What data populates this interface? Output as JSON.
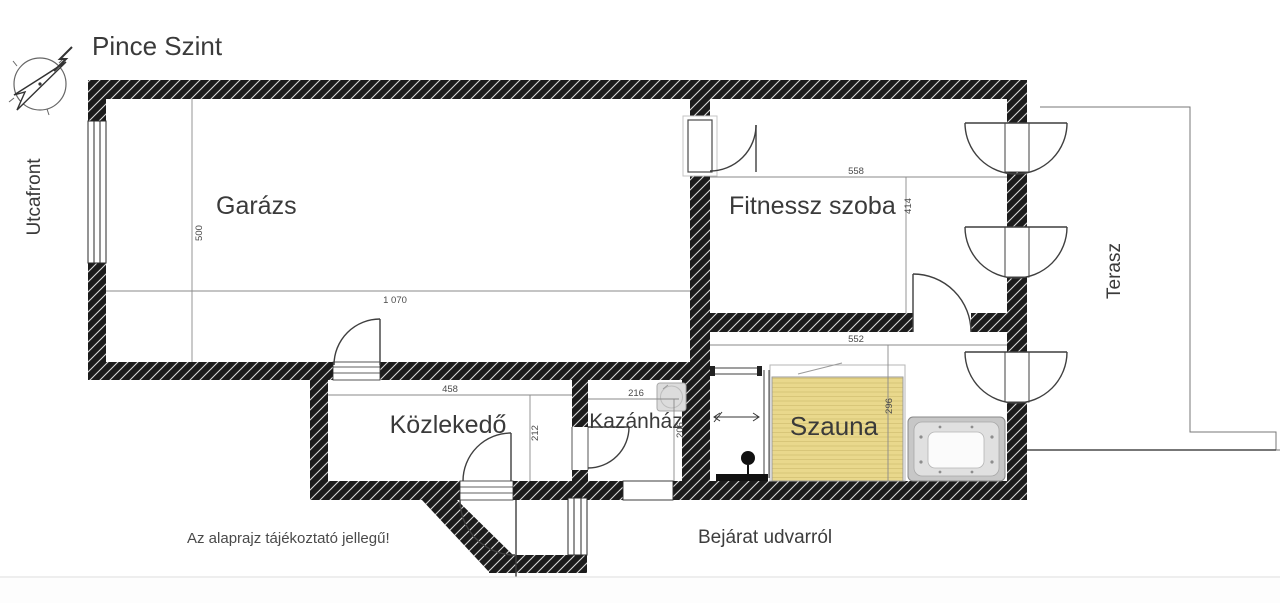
{
  "page": {
    "title": "Pince Szint",
    "street_label": "Utcafront",
    "terrace_label": "Terasz",
    "note": "Az alaprajz tájékoztató jellegű!",
    "entrance": "Bejárat udvarról"
  },
  "rooms": [
    {
      "id": "garazs",
      "label": "Garázs",
      "width": "1 070",
      "height": "500"
    },
    {
      "id": "fitnessz",
      "label": "Fitnessz szoba",
      "width": "558",
      "height": "414"
    },
    {
      "id": "kozlekedo",
      "label": "Közlekedő",
      "width": "458",
      "height": "212"
    },
    {
      "id": "kazanhaz",
      "label": "Kazánház",
      "width": "216",
      "height": "206"
    },
    {
      "id": "szauna",
      "label": "Szauna",
      "width": "552",
      "height": "296"
    }
  ],
  "icons": [
    "compass-north-icon",
    "jacuzzi-icon",
    "shower-head-icon",
    "boiler-icon"
  ],
  "colors": {
    "wall": "#1c1c1c",
    "hatch_line": "#d6d6d6",
    "sauna_fill": "#e9d88c",
    "text": "#3a3a3a",
    "terrace_line": "#4a4a4a"
  }
}
